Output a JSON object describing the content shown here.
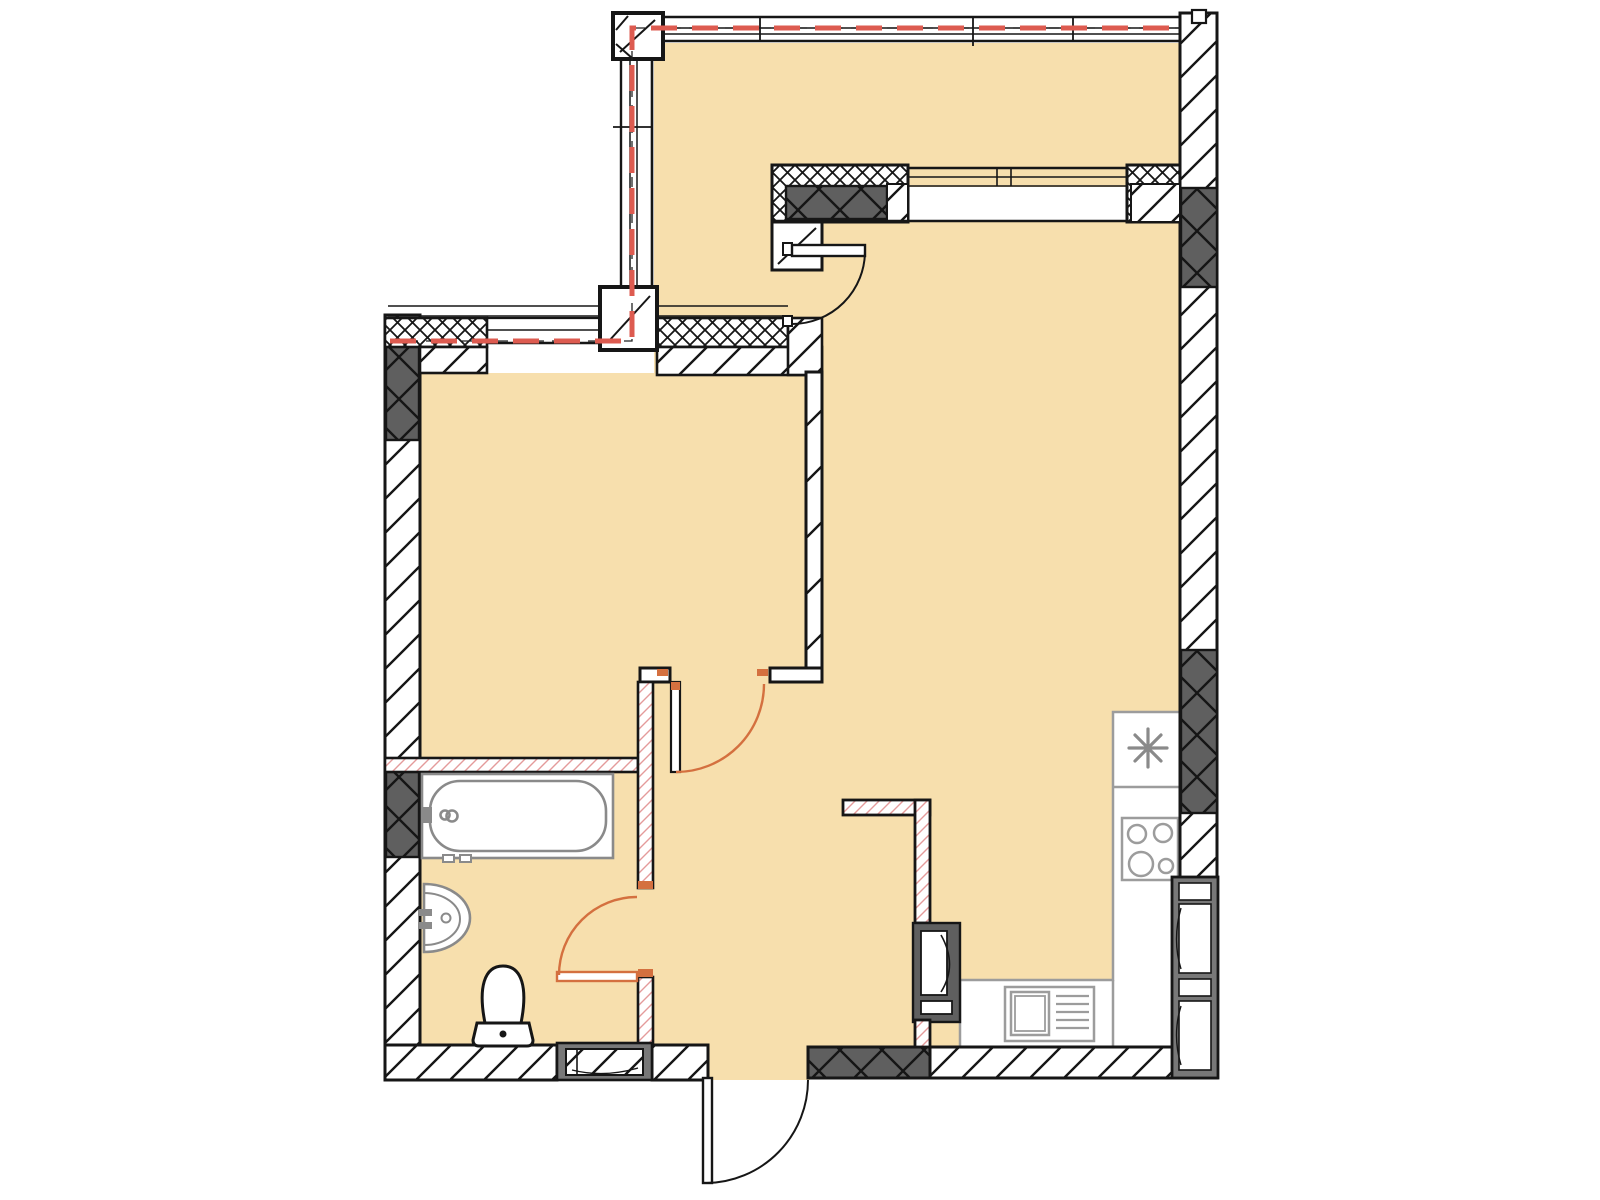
{
  "canvas": {
    "width": 1600,
    "height": 1200,
    "background": "#ffffff"
  },
  "palette": {
    "floor": "#f7dfad",
    "wall": "#161616",
    "dark": "#5f5f5f",
    "pink": "#e49b9b",
    "red": "#dd5b50",
    "orange": "#d4703f",
    "fix": "#8a8a8a",
    "counter": "#9c9c9c",
    "frame": "#787878",
    "bg": "#ffffff"
  },
  "plan": {
    "type": "apartment-floor-plan",
    "boundary_marking": "red-dashed-reconstruction-line",
    "fixtures": [
      "bathtub",
      "washbasin",
      "toilet",
      "cooktop-4-burner",
      "kitchen-sink-with-drainer",
      "refrigerator-asterisk-mark",
      "kitchen-counter",
      "ventilation-shaft"
    ],
    "doors": [
      "entrance-door",
      "balcony-door",
      "bedroom-door",
      "bathroom-door"
    ],
    "windows": [
      "top-panoramic-glazing",
      "left-panoramic-glazing",
      "bedroom-window",
      "loggia-interior-window",
      "bathroom-small-window",
      "right-wall-window-block"
    ]
  }
}
